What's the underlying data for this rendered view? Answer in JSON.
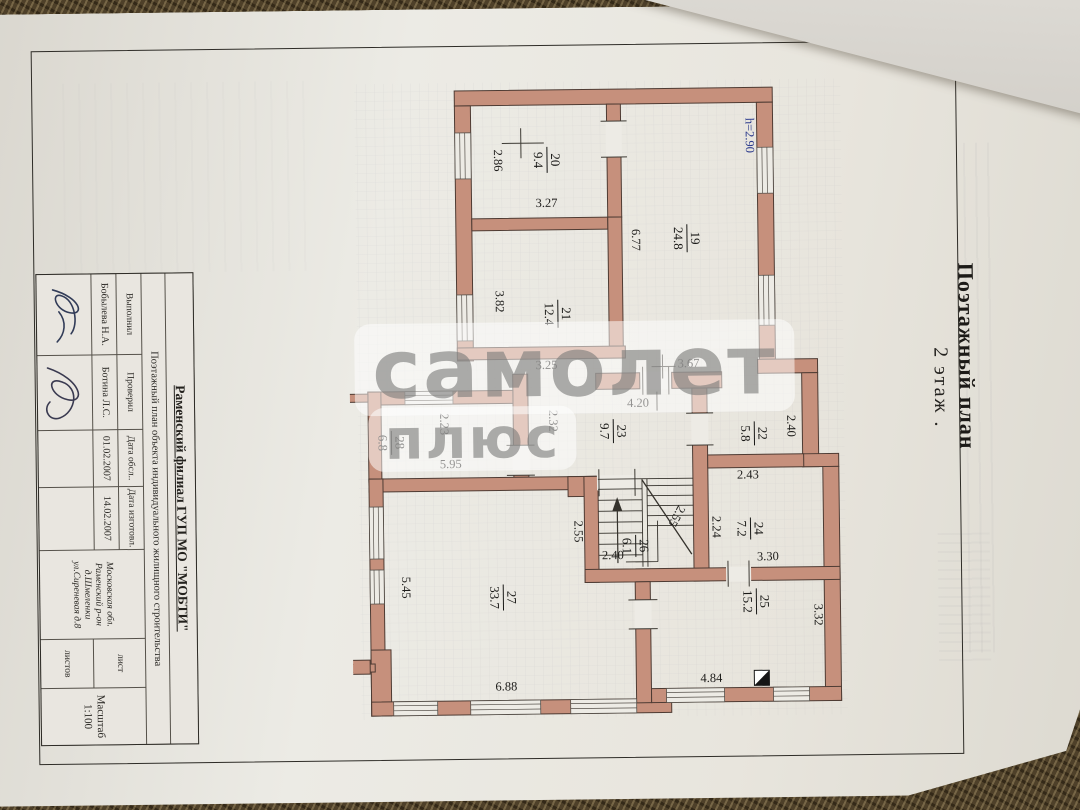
{
  "doc": {
    "title": "Поэтажный план",
    "floor": "2  этаж .",
    "org": "Раменский филиал  ГУП  МО \"МОБТИ\"",
    "purpose": "Поэтажный план объекта  индивидуального  жилищного  строительства",
    "stamp": {
      "made_label": "Выполнил",
      "made_name": "Бобылева Н.А.",
      "check_label": "Проверил",
      "check_name": "Ботина Л.С.",
      "survey_label": "Дата обсл..",
      "survey_value": "01.02.2007",
      "issue_label": "Дата изготовл.",
      "issue_value": "14.02.2007",
      "addr1": "Московская обл. Раменский р-он",
      "addr2": "д.Шмеленки ул.Сиреневая д.8",
      "sheet": "лист",
      "sheets": "листов",
      "scale": "Масштаб 1:100"
    },
    "watermark1": "самолет",
    "watermark2": "плюс",
    "plan": {
      "lit_main": "лит. А",
      "lit_annex": "лит. а3",
      "rooms": [
        {
          "num": "20",
          "area": "9.4"
        },
        {
          "num": "19",
          "area": "24.8"
        },
        {
          "num": "21",
          "area": "12.4"
        },
        {
          "num": "23",
          "area": "9.7"
        },
        {
          "num": "22",
          "area": "5.8"
        },
        {
          "num": "28",
          "area": "6.8"
        },
        {
          "num": "26",
          "area": "6.1"
        },
        {
          "num": "24",
          "area": "7.2"
        },
        {
          "num": "25",
          "area": "15.2"
        },
        {
          "num": "27",
          "area": "33.7"
        }
      ],
      "dims": [
        {
          "t": "2.86"
        },
        {
          "t": "3.27"
        },
        {
          "t": "6.77"
        },
        {
          "t": "3.82"
        },
        {
          "t": "3.25"
        },
        {
          "t": "3.67"
        },
        {
          "t": "4.20"
        },
        {
          "t": "2.32"
        },
        {
          "t": "2.40"
        },
        {
          "t": "2.43"
        },
        {
          "t": "2.23"
        },
        {
          "t": "5.95"
        },
        {
          "t": "7.50"
        },
        {
          "t": "7.30"
        },
        {
          "t": "5.45"
        },
        {
          "t": "2.55"
        },
        {
          "t": "2.55"
        },
        {
          "t": "2.40"
        },
        {
          "t": "2.24"
        },
        {
          "t": "3.30"
        },
        {
          "t": "3.32"
        },
        {
          "t": "4.84"
        },
        {
          "t": "6.88"
        },
        {
          "t": "h=2.90"
        }
      ]
    }
  },
  "colors": {
    "wall": "#c6907c",
    "paper": "#e9e6e0",
    "lit_red": "#a8372c",
    "note_blue": "#2b3a8c"
  }
}
